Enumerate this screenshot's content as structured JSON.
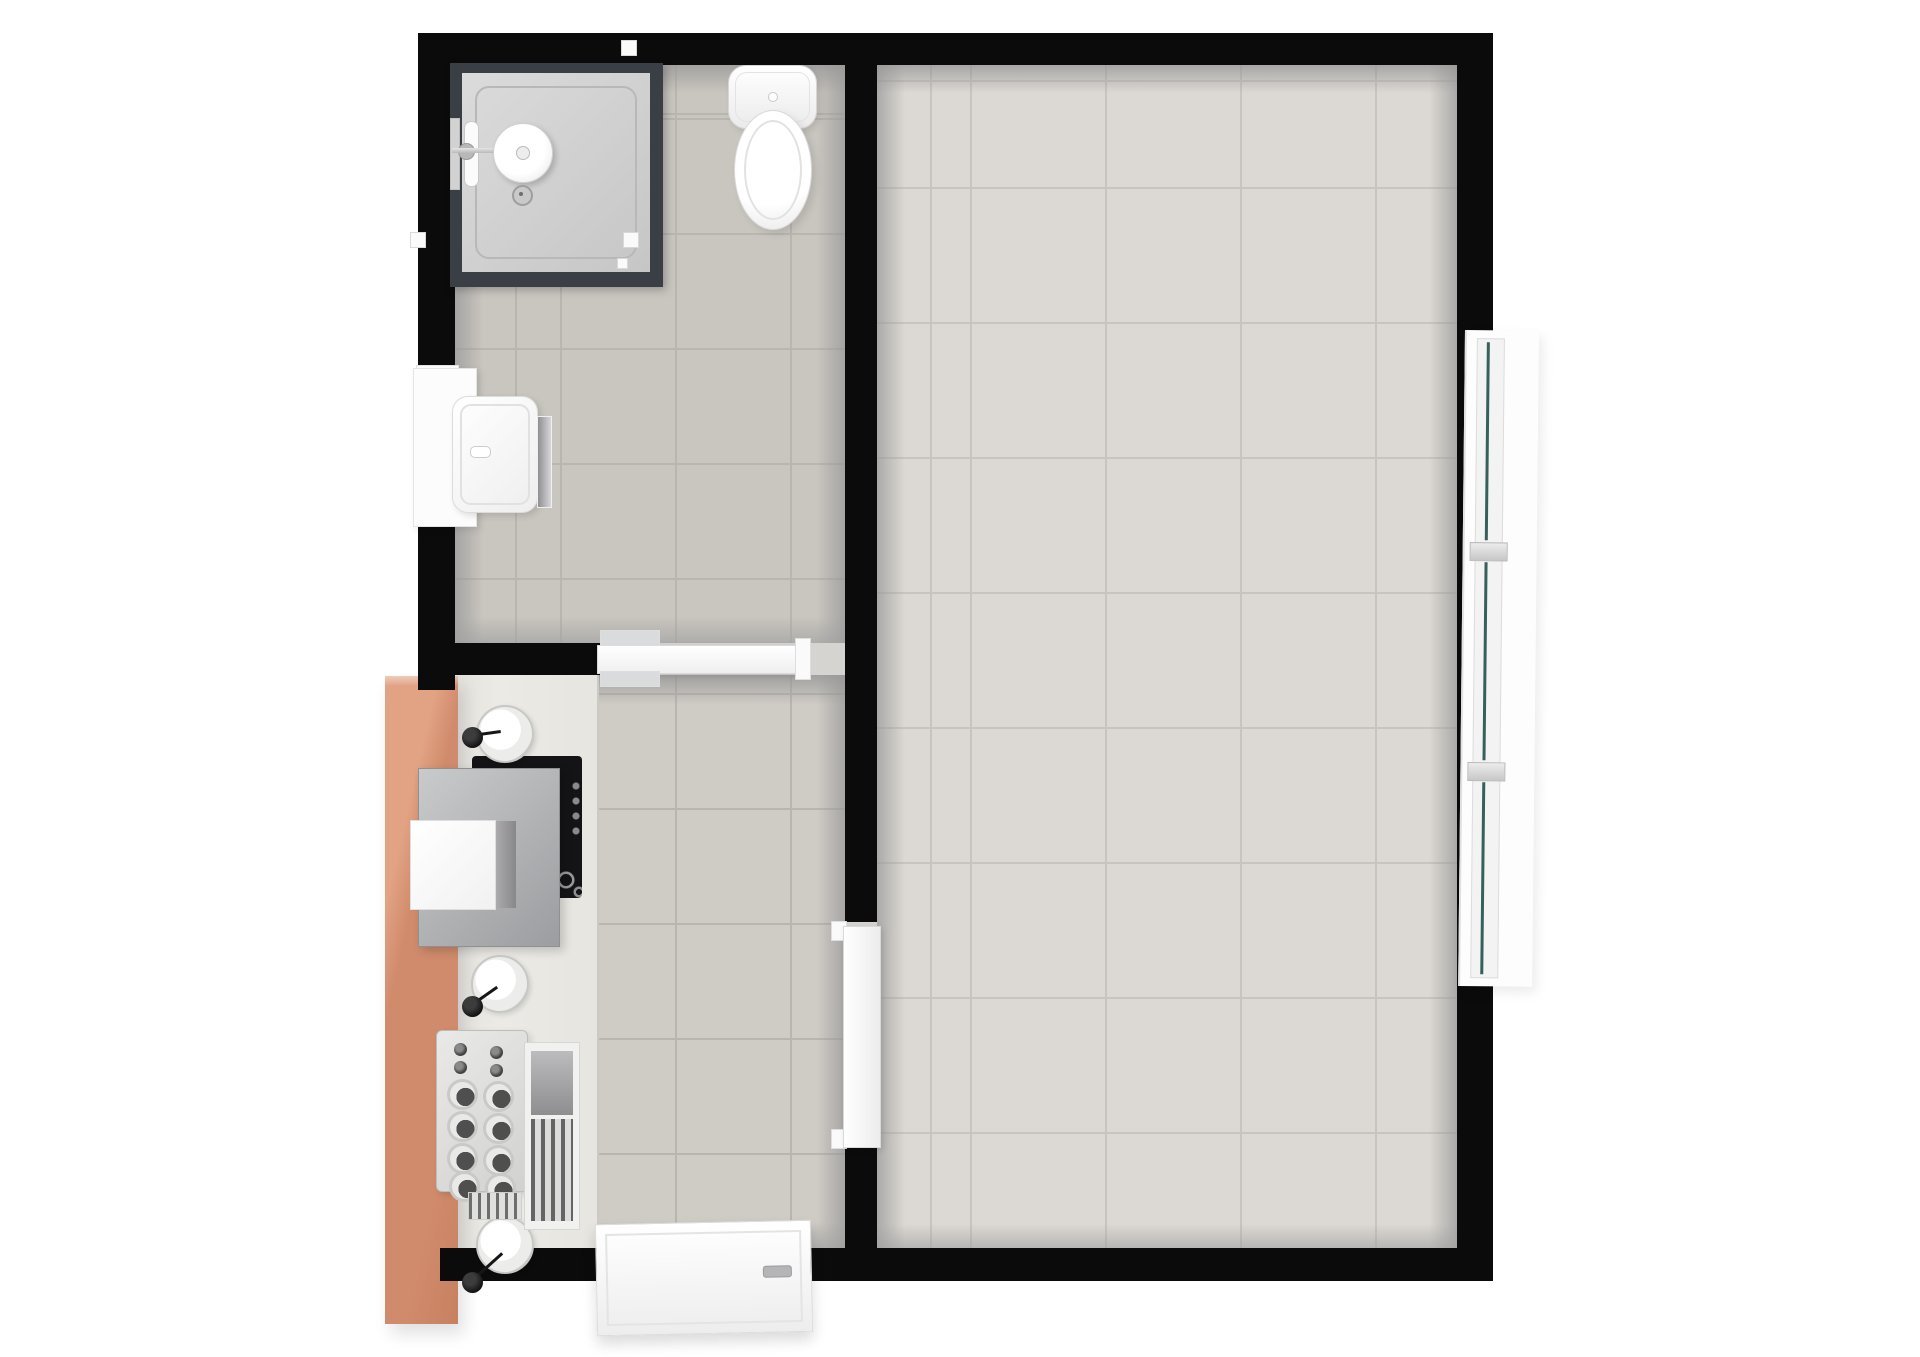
{
  "meta": {
    "type": "3d-floorplan-render",
    "description": "Top-down 3D rendering of a small apartment floor plan with bathroom, kitchen hallway and one large tiled room",
    "visible_text": ""
  },
  "colors": {
    "bg": "#ffffff",
    "wall": "#0b0b0b",
    "bath-tile": "#c9c5bf",
    "hall-tile": "#cfcbc5",
    "room-tile": "#dcd8d3",
    "grout-a": "#b9b5af",
    "grout-b": "#c8c4bf",
    "counter": "#e8e6e1",
    "copper": "#d08b6c",
    "copper-light": "#e2a284",
    "glass": "#3a3e45",
    "glass-teal": "#35605b",
    "cooktop": "#141417",
    "fixture-white": "#ffffff",
    "chrome": "#c6c6c6"
  },
  "rooms": [
    {
      "name": "bathroom",
      "fixtures": [
        "shower-cabin",
        "shower-head",
        "toilet",
        "washbasin",
        "vanity",
        "mirror-shelf",
        "wall-window"
      ]
    },
    {
      "name": "hallway-kitchen",
      "fixtures": [
        "kitchen-counter",
        "copper-tall-panel",
        "extractor-hood",
        "cooktop",
        "round-sink-1",
        "round-sink-2",
        "round-sink-3",
        "faucet-knobs",
        "dish-rack",
        "drainboard",
        "bathroom-door",
        "entrance-door-slab"
      ]
    },
    {
      "name": "living-room",
      "fixtures": [
        "open-casement-window",
        "interior-door"
      ]
    }
  ]
}
